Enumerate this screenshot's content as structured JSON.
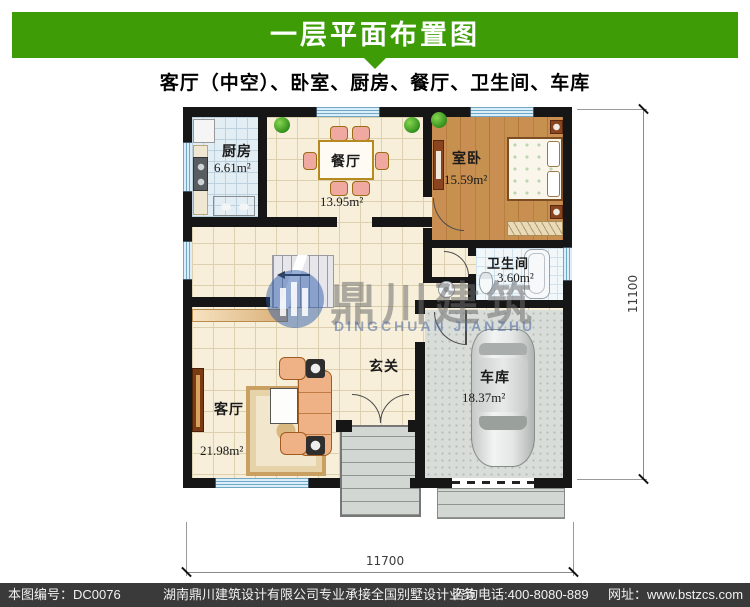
{
  "colors": {
    "accent_green": "#3E9C07",
    "footer_bg": "#3A3A3A",
    "wall": "#161616"
  },
  "header": {
    "title": "一层平面布置图"
  },
  "subtitle": "客厅（中空）、卧室、厨房、餐厅、卫生间、车库",
  "rooms": {
    "kitchen": {
      "name": "厨房",
      "area": "6.61m²"
    },
    "dining": {
      "name": "餐厅",
      "area": "13.95m²"
    },
    "bedroom": {
      "name": "室卧",
      "area": "15.59m²"
    },
    "bathroom": {
      "name": "卫生间",
      "area": "3.60m²"
    },
    "foyer": {
      "name": "玄关"
    },
    "living": {
      "name": "客厅",
      "area": "21.98m²"
    },
    "garage": {
      "name": "车库",
      "area": "18.37m²"
    }
  },
  "dimensions": {
    "bottom_width": "11700",
    "right_height": "11100"
  },
  "watermark": {
    "zh": "鼎川建筑",
    "en": "DINGCHUAN JIANZHU"
  },
  "footer": {
    "serial": "本图编号：DC0076",
    "company": "湖南鼎川建筑设计有限公司专业承接全国别墅设计业务",
    "phone": "咨询电话:400-8080-889",
    "website": "网址：www.bstzcs.com"
  }
}
